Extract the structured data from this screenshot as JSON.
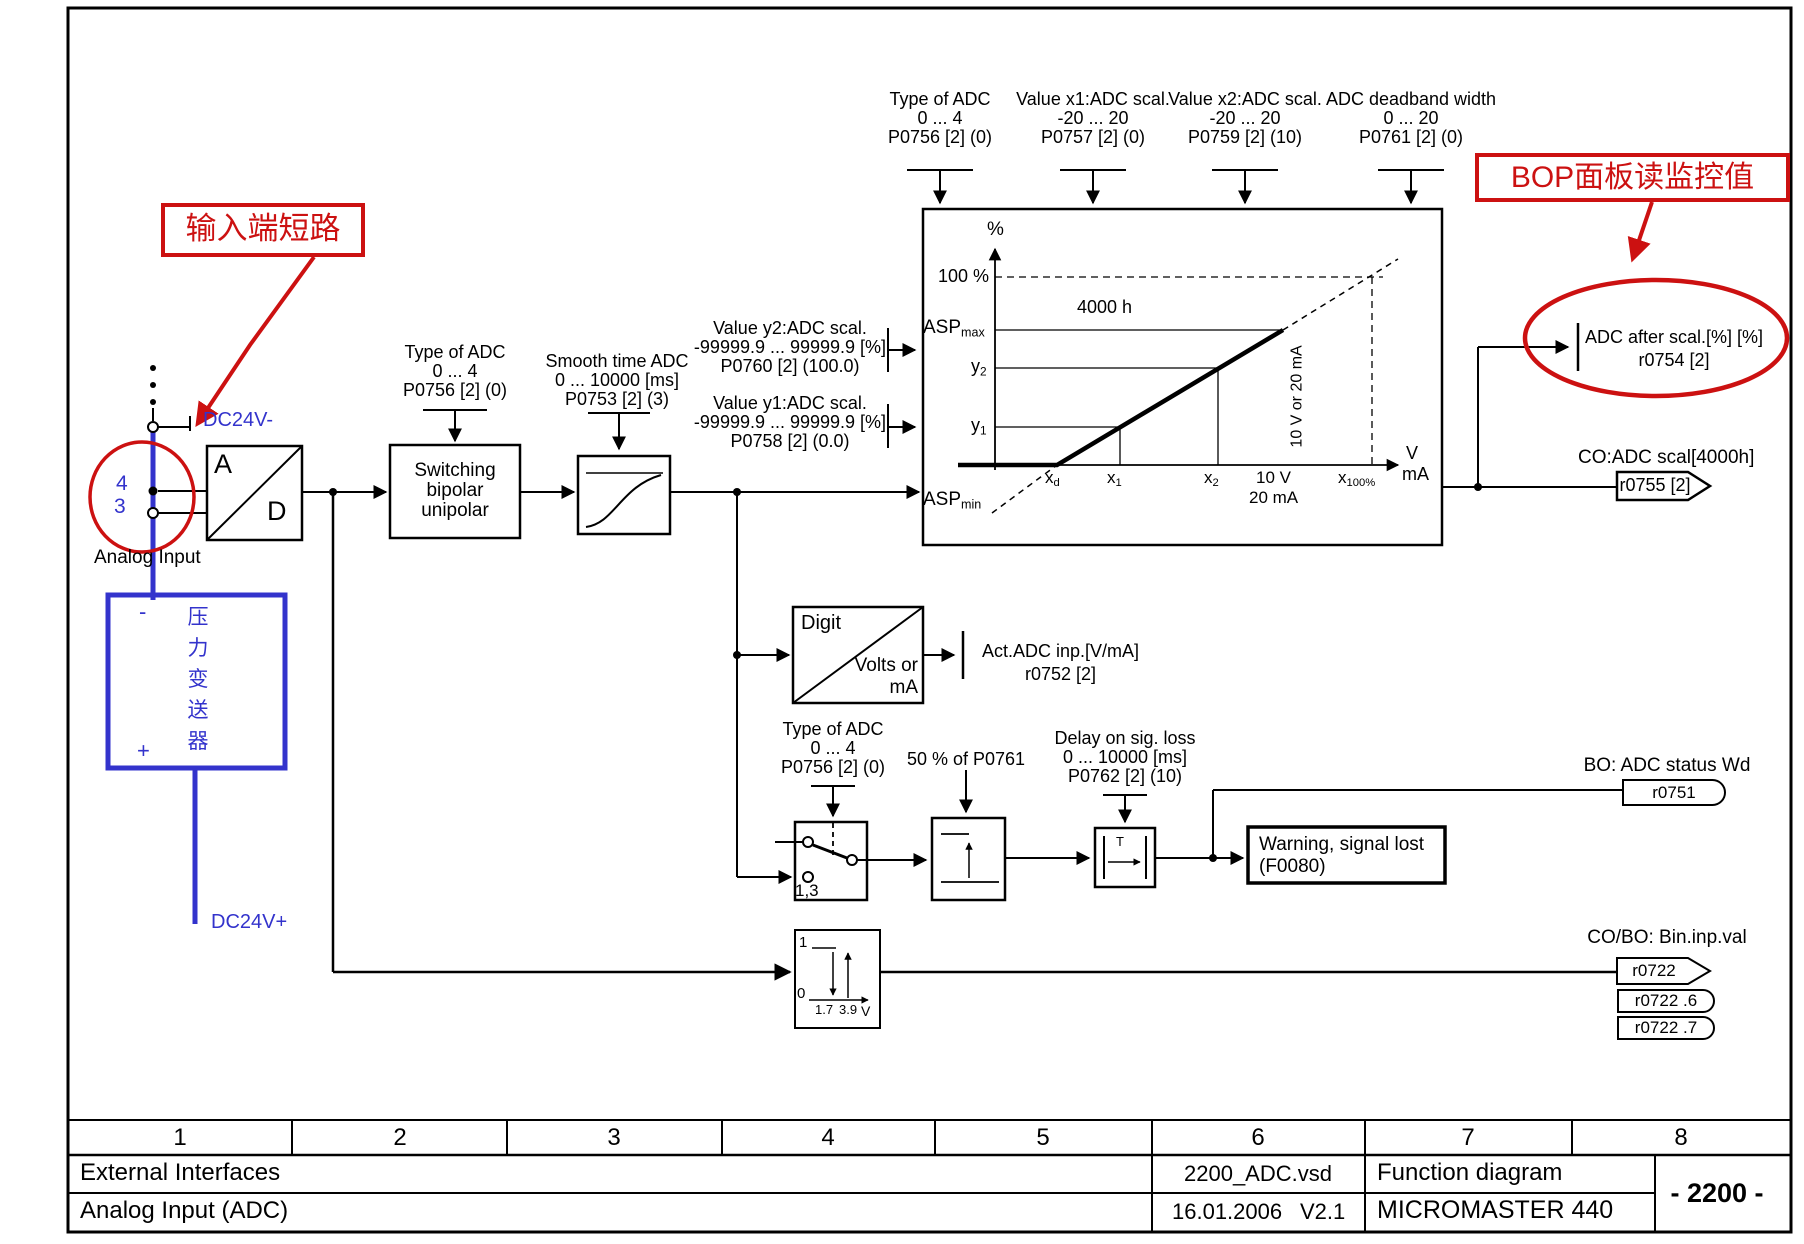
{
  "colors": {
    "annotation_red": "#cc1111",
    "wire_blue": "#3333cc",
    "line_black": "#000000",
    "page_bg": "#ffffff"
  },
  "top_params": {
    "type_of_adc": {
      "l1": "Type of ADC",
      "l2": "0 ... 4",
      "l3": "P0756 [2] (0)"
    },
    "value_x1": {
      "l1": "Value x1:ADC scal.",
      "l2": "-20 ... 20",
      "l3": "P0757 [2] (0)"
    },
    "value_x2": {
      "l1": "Value x2:ADC scal.",
      "l2": "-20 ... 20",
      "l3": "P0759 [2] (10)"
    },
    "deadband": {
      "l1": "ADC deadband width",
      "l2": "0 ... 20",
      "l3": "P0761 [2] (0)"
    }
  },
  "annotations": {
    "short_circuit": "输入端短路",
    "bop_monitor": "BOP面板读监控值"
  },
  "input": {
    "terminal_4": "4",
    "terminal_3": "3",
    "analog_input": "Analog Input",
    "dc24v_minus": "DC24V-",
    "dc24v_plus": "DC24V+",
    "transmitter": {
      "minus": "-",
      "plus": "+",
      "chars": [
        "压",
        "力",
        "变",
        "送",
        "器"
      ]
    },
    "adc": {
      "a": "A",
      "d": "D"
    }
  },
  "blocks": {
    "switching": {
      "l1": "Switching",
      "l2": "bipolar",
      "l3": "unipolar"
    },
    "smooth": {
      "l1": "Smooth time ADC",
      "l2": "0 ... 10000 [ms]",
      "l3": "P0753 [2] (3)"
    },
    "digit": {
      "l1": "Digit",
      "l2": "Volts or",
      "l3": "mA"
    },
    "switch_type": {
      "l1": "Type of ADC",
      "l2": "0 ... 4",
      "l3": "P0756 [2] (0)"
    },
    "switch_pins": "1,3",
    "hysteresis_label": "50 % of P0761",
    "delay": {
      "l1": "Delay on sig. loss",
      "l2": "0 ... 10000 [ms]",
      "l3": "P0762 [2] (10)",
      "t": "T"
    },
    "warning": {
      "l1": "Warning, signal lost",
      "l2": "(F0080)"
    }
  },
  "scaling_params": {
    "value_y2": {
      "l1": "Value y2:ADC scal.",
      "l2": "-99999.9 ... 99999.9 [%]",
      "l3": "P0760 [2] (100.0)"
    },
    "value_y1": {
      "l1": "Value y1:ADC scal.",
      "l2": "-99999.9 ... 99999.9 [%]",
      "l3": "P0758 [2] (0.0)"
    }
  },
  "graph": {
    "percent": "%",
    "hundred_pct": "100 %",
    "asp": "ASP",
    "max": "max",
    "min": "min",
    "hours": "4000 h",
    "y": "y",
    "x": "x",
    "one": "1",
    "two": "2",
    "d": "d",
    "pct100": "100%",
    "v10": "10 V",
    "ma20": "20 mA",
    "v": "V",
    "ma": "mA",
    "range_rot": "10 V or 20 mA"
  },
  "outputs": {
    "act_adc": {
      "l1": "Act.ADC inp.[V/mA]",
      "l2": "r0752 [2]"
    },
    "after_scal": {
      "l1": "ADC after scal.[%] [%]",
      "l2": "r0754 [2]"
    },
    "co_scal": {
      "label": "CO:ADC scal[4000h]",
      "value": "r0755 [2]"
    },
    "bo_status": {
      "label": "BO: ADC status Wd",
      "value": "r0751"
    },
    "bin": {
      "label": "CO/BO: Bin.inp.val",
      "v1": "r0722",
      "v2": "r0722 .6",
      "v3": "r0722 .7"
    },
    "binary_block": {
      "one": "1",
      "zero": "0",
      "t1": "1.7",
      "t2": "3.9",
      "v": "V"
    }
  },
  "titleblock": {
    "cols": [
      "1",
      "2",
      "3",
      "4",
      "5",
      "6",
      "7",
      "8"
    ],
    "row2": {
      "left": "External Interfaces",
      "file": "2200_ADC.vsd",
      "function": "Function diagram"
    },
    "row3": {
      "left": "Analog Input (ADC)",
      "date": "16.01.2006",
      "version": "V2.1",
      "product": "MICROMASTER 440"
    },
    "page": "- 2200 -"
  }
}
